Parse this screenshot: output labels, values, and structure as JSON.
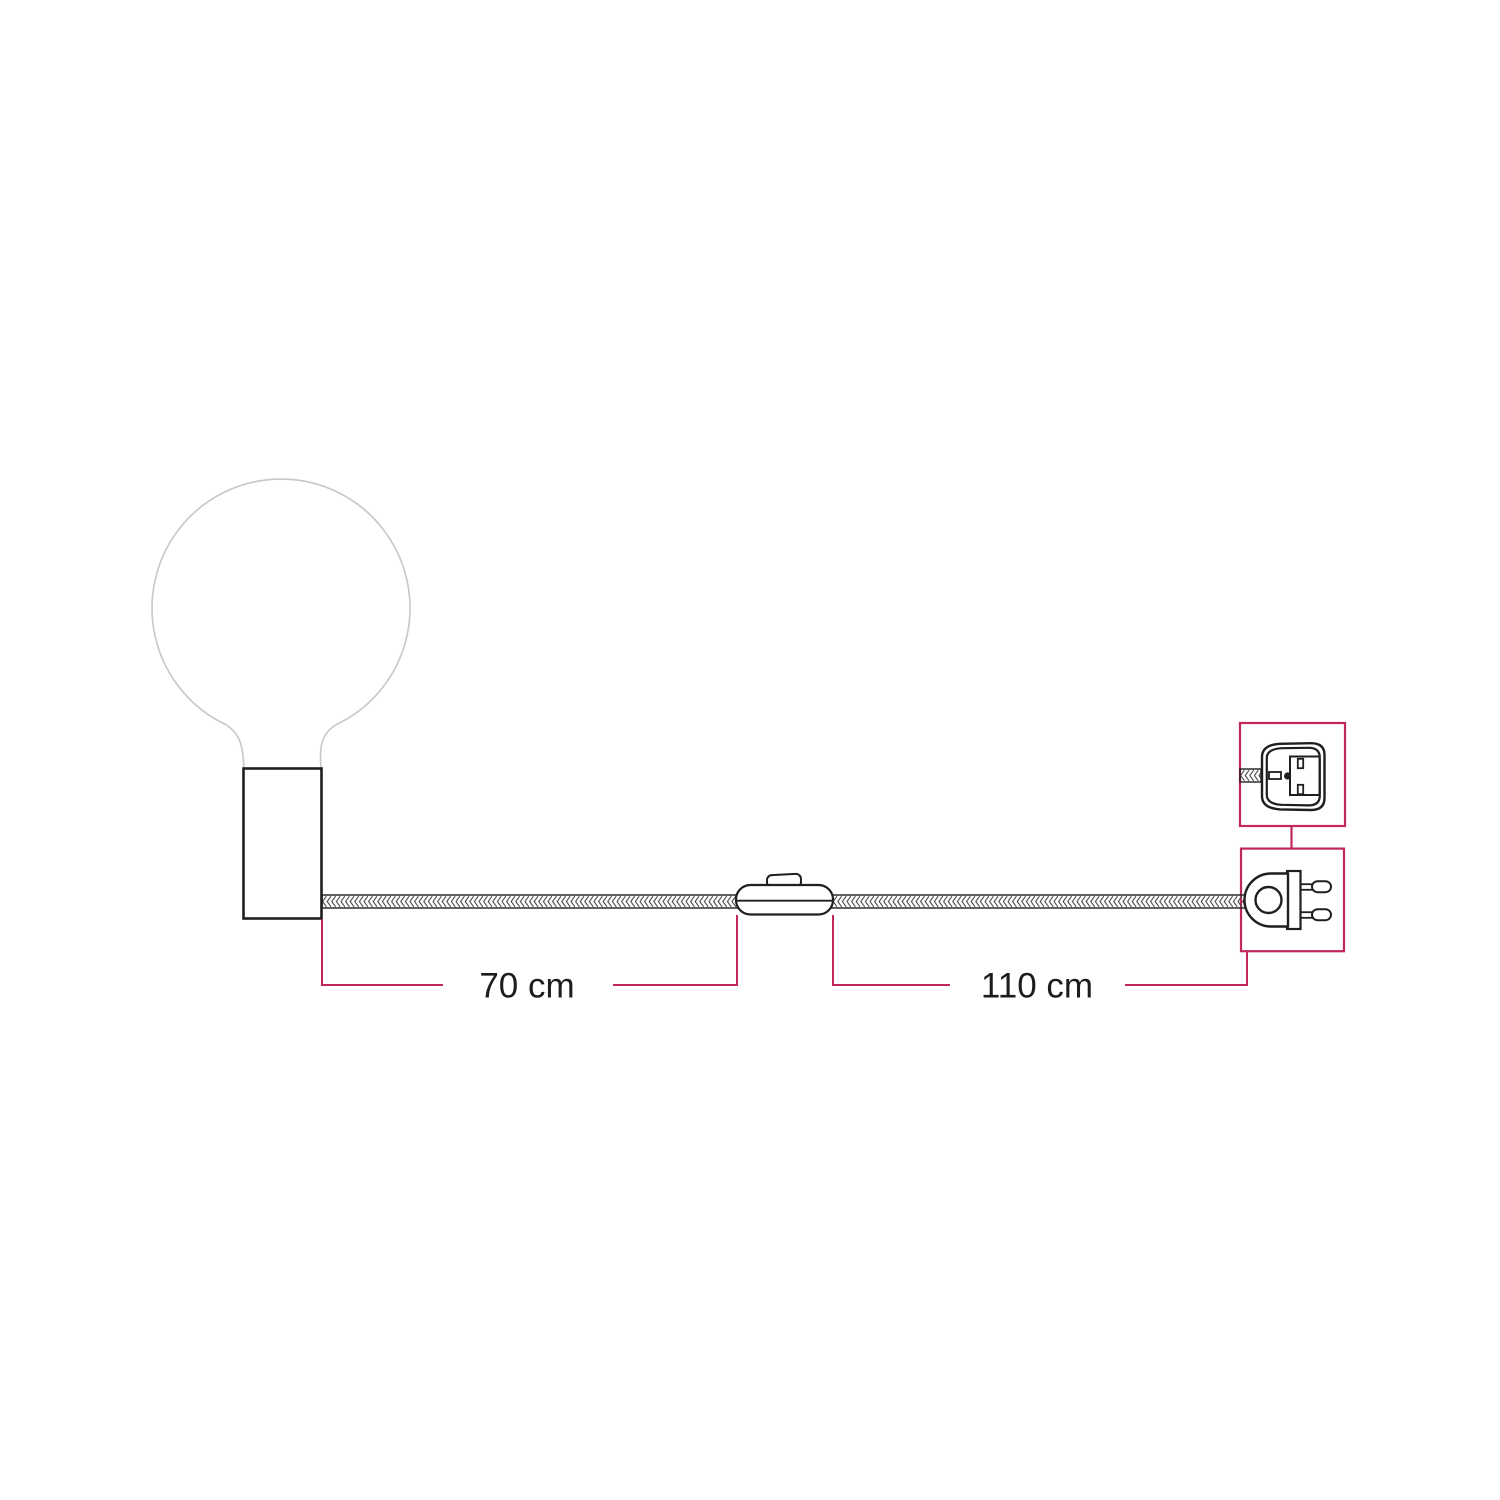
{
  "page": {
    "background": "#ffffff"
  },
  "colors": {
    "accent": "#c2265e",
    "outline": "#1f1f1f",
    "bulb_outline": "#c7c7c7",
    "braid": "#4a4a4a"
  },
  "dimensions": {
    "holder_to_switch": {
      "label": "70 cm"
    },
    "switch_to_plug": {
      "label": "110 cm"
    }
  },
  "icons": {
    "bulb": "globe-light-bulb-outline",
    "holder": "cylinder-lamp-holder",
    "cable": "braided-textile-cable",
    "switch": "inline-rocker-switch",
    "plug_face": "two-pin-plug-face-detail",
    "plug_side": "two-pin-plug-side-view"
  }
}
